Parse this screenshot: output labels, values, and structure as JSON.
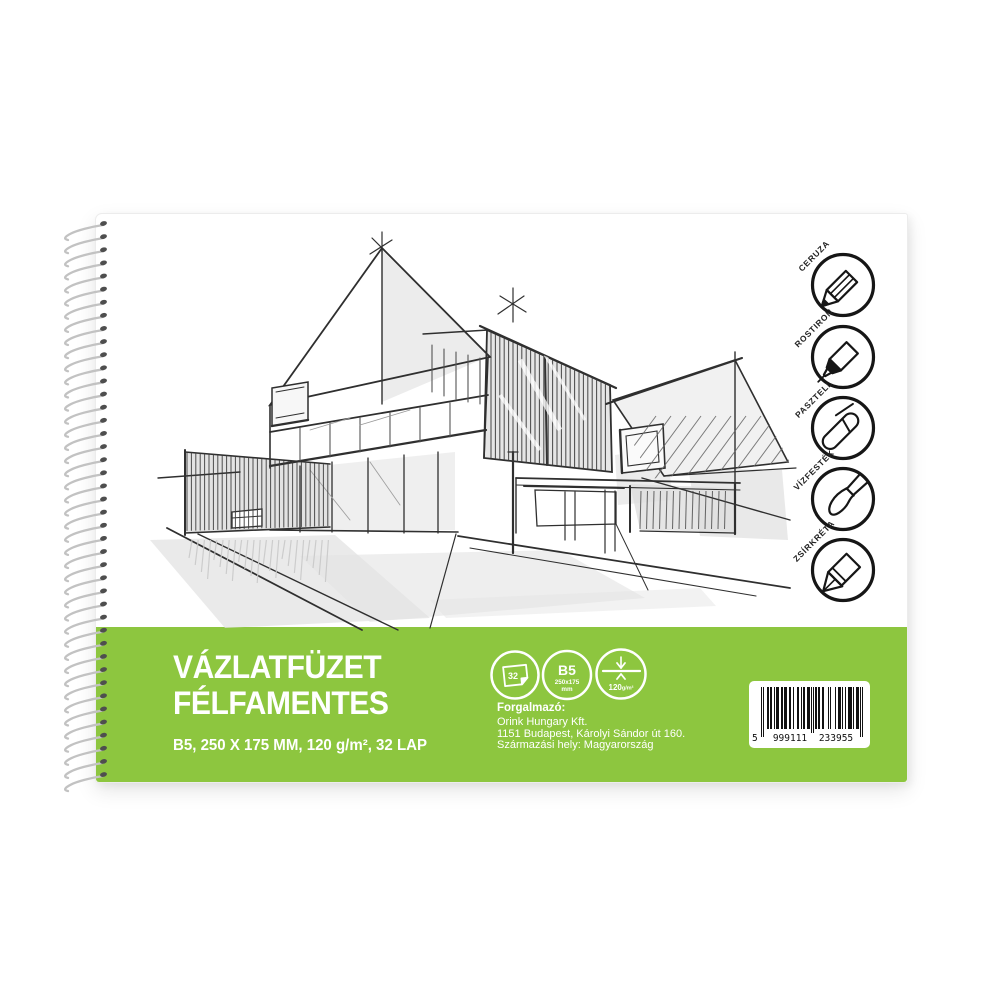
{
  "cover": {
    "title_line1": "VÁZLATFÜZET",
    "title_line2": "FÉLFAMENTES",
    "subtitle": "B5, 250 X 175 MM, 120 g/m², 32 LAP"
  },
  "media_icons": [
    {
      "name": "pencil",
      "label": "CERUZA"
    },
    {
      "name": "fineliner",
      "label": "ROSTIRON"
    },
    {
      "name": "pastel",
      "label": "PASZTELL"
    },
    {
      "name": "watercolor",
      "label": "VÍZFESTÉK"
    },
    {
      "name": "wax-crayon",
      "label": "ZSÍRKRÉTA"
    }
  ],
  "badges": {
    "sheet_count": "32",
    "size_code": "B5",
    "size_mm": "250x175",
    "size_unit": "mm",
    "weight_value": "120",
    "weight_unit": "g/m²"
  },
  "distributor": {
    "heading": "Forgalmazó:",
    "company": "Orink Hungary Kft.",
    "address": "1151 Budapest, Károlyi Sándor út 160.",
    "origin": "Származási hely: Magyarország"
  },
  "barcode": {
    "value": "5999111233955",
    "display_first": "5",
    "display_group1": "999111",
    "display_group2": "233955",
    "segments": [
      "101",
      "0001011",
      "0010111",
      "0010111",
      "0011001",
      "0011001",
      "0110011",
      "01010",
      "1101100",
      "1000010",
      "1000010",
      "1110100",
      "1001110",
      "1001110",
      "101"
    ]
  },
  "colors": {
    "band_green": "#8dc63f",
    "ink": "#222222"
  }
}
